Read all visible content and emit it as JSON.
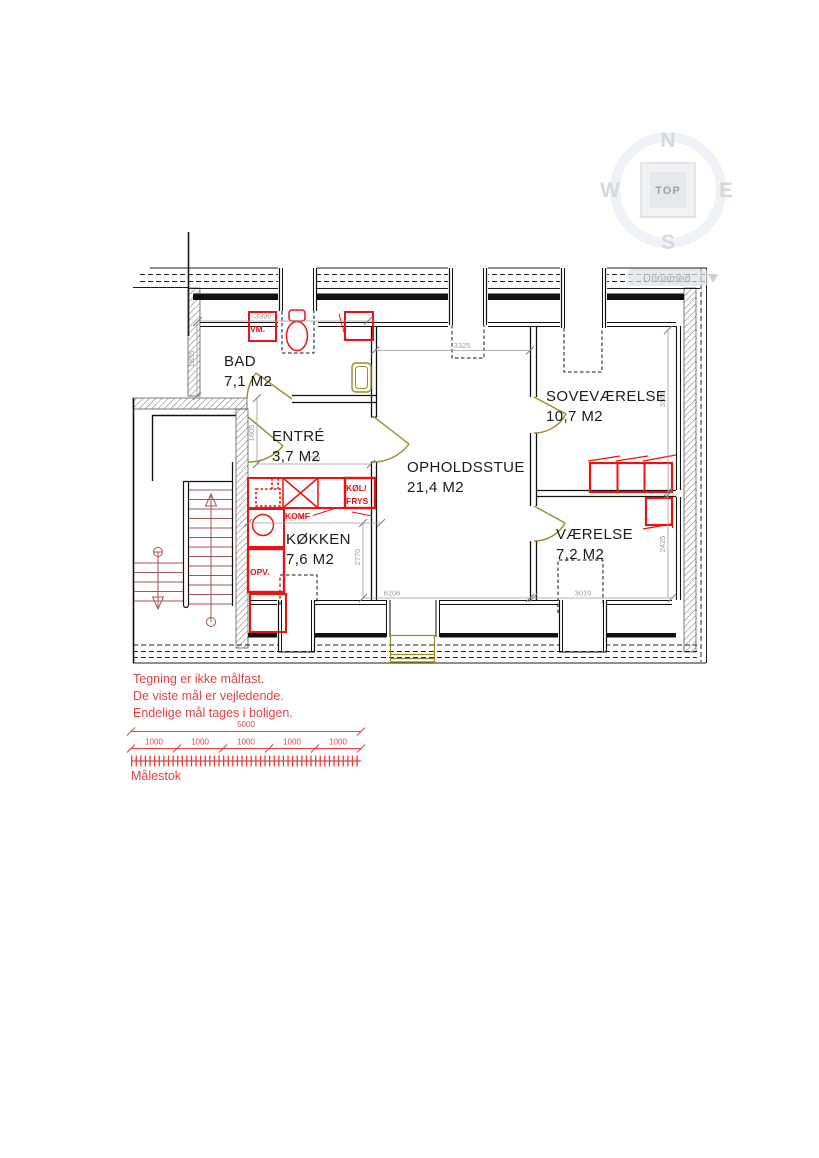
{
  "compass": {
    "n": "N",
    "e": "E",
    "s": "S",
    "w": "W",
    "cube_label": "TOP"
  },
  "viewport": {
    "label": "Unnamed"
  },
  "rooms": [
    {
      "name": "BAD",
      "area": "7,1 M2"
    },
    {
      "name": "ENTRÉ",
      "area": "3,7 M2"
    },
    {
      "name": "OPHOLDSSTUE",
      "area": "21,4 M2"
    },
    {
      "name": "SOVEVÆRELSE",
      "area": "10,7 M2"
    },
    {
      "name": "VÆRELSE",
      "area": "7,2 M2"
    },
    {
      "name": "KØKKEN",
      "area": "7,6 M2"
    }
  ],
  "fixtures": {
    "washing_machine": "VM.",
    "stove": "KOMF",
    "fridge_line1": "KØL/",
    "fridge_line2": "FRYS",
    "dishwasher": "OPV."
  },
  "dimensions": {
    "bad_width": "3996",
    "bad_depth": "1835",
    "dormer_width": "3325",
    "entre_depth": "1605",
    "entre_width": "2770",
    "kitchen_width": "2770",
    "kitchen_depth": "2770",
    "stue_width": "6206",
    "vaerelse_width": "3010",
    "sove_depth": "3558",
    "vaerelse_depth": "2425"
  },
  "notes": [
    "Tegning er ikke målfast.",
    "De viste mål er vejledende.",
    "Endelige mål tages i boligen."
  ],
  "scale_bar": {
    "total": "5000",
    "segments": [
      "1000",
      "1000",
      "1000",
      "1000",
      "1000"
    ],
    "caption": "Målestok"
  },
  "colors": {
    "fixture_red": "#e81313",
    "note_red": "#e04343",
    "door_olive": "#9a8a28",
    "dimension_grey": "#9b9b9b",
    "stair_red": "#a25353",
    "compass_grey": "#d4d8dd",
    "wall_black": "#111111"
  }
}
